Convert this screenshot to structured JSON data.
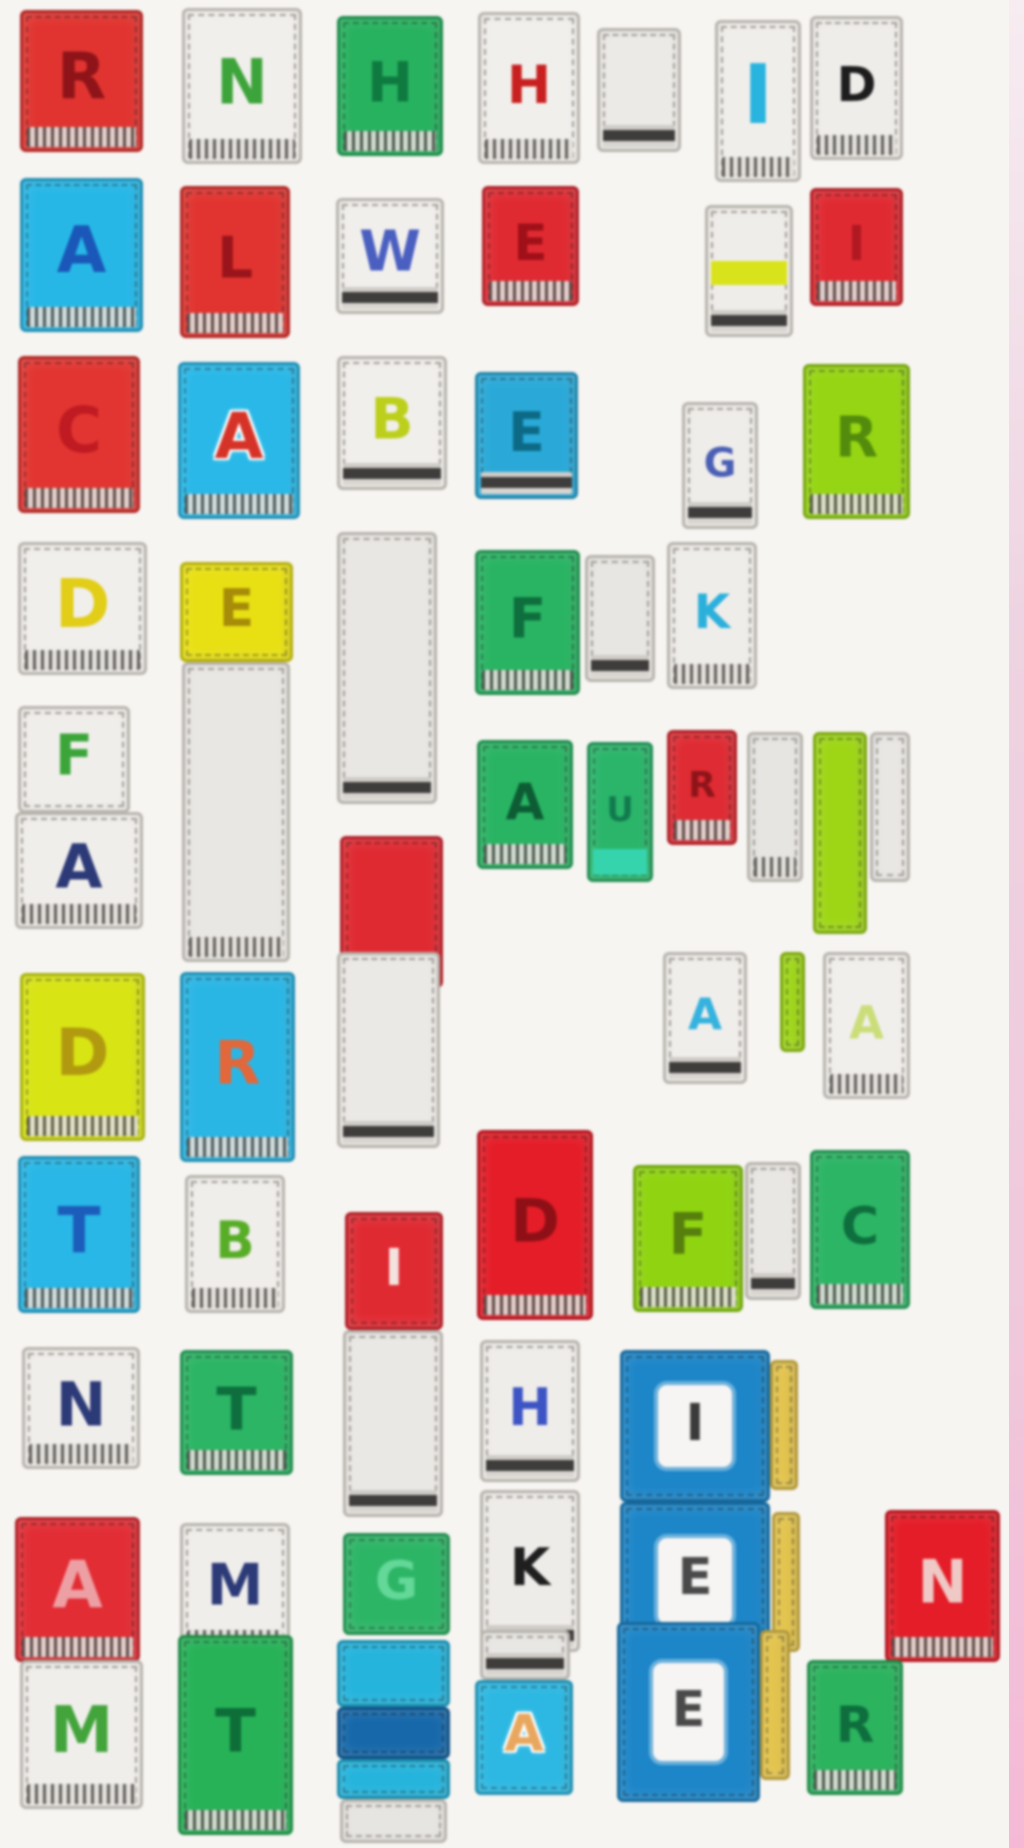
{
  "scene": {
    "description": "Blurry photo collage of toy alphabet letter blocks on a white background",
    "background": "#f7f5f2",
    "edge_strip_color": "#f0cfe0"
  },
  "blocks": [
    {
      "letter": "R",
      "letter_color": "#8e1419",
      "bg": "#e13430",
      "x": 20,
      "y": 10,
      "w": 123,
      "h": 142,
      "fringe": "s"
    },
    {
      "letter": "N",
      "letter_color": "#3ca43a",
      "bg": "#f1efec",
      "x": 182,
      "y": 8,
      "w": 120,
      "h": 156,
      "fringe": "s",
      "light": true
    },
    {
      "letter": "H",
      "letter_color": "#0f7a40",
      "bg": "#27b25f",
      "x": 337,
      "y": 16,
      "w": 106,
      "h": 140,
      "fringe": "s"
    },
    {
      "letter": "H",
      "letter_color": "#c8201f",
      "bg": "#f1efec",
      "x": 478,
      "y": 12,
      "w": 102,
      "h": 152,
      "fringe": "s",
      "light": true
    },
    {
      "letter": "",
      "letter_color": "",
      "bg": "#eceae7",
      "x": 597,
      "y": 28,
      "w": 84,
      "h": 124,
      "fringe": "d",
      "light": true
    },
    {
      "letter": "I",
      "letter_color": "#28b4de",
      "bg": "#f0eeeb",
      "x": 715,
      "y": 20,
      "w": 86,
      "h": 162,
      "fringe": "s",
      "light": true,
      "fs": 82
    },
    {
      "letter": "D",
      "letter_color": "#1d1d1d",
      "bg": "#efedea",
      "x": 810,
      "y": 16,
      "w": 93,
      "h": 144,
      "fringe": "s",
      "light": true
    },
    {
      "letter": "A",
      "letter_color": "#1a57b8",
      "bg": "#27b7e6",
      "x": 20,
      "y": 178,
      "w": 123,
      "h": 154,
      "fringe": "s"
    },
    {
      "letter": "L",
      "letter_color": "#9a141b",
      "bg": "#e13430",
      "x": 180,
      "y": 186,
      "w": 110,
      "h": 152,
      "fringe": "s"
    },
    {
      "letter": "W",
      "letter_color": "#4a5fc0",
      "bg": "#f1efec",
      "x": 336,
      "y": 198,
      "w": 108,
      "h": 116,
      "fringe": "d",
      "light": true
    },
    {
      "letter": "E",
      "letter_color": "#a01018",
      "bg": "#e02a32",
      "x": 482,
      "y": 186,
      "w": 97,
      "h": 120,
      "fringe": "s"
    },
    {
      "letter": "",
      "letter_color": "",
      "bg": "#efedea",
      "x": 705,
      "y": 205,
      "w": 88,
      "h": 132,
      "fringe": "d",
      "light": true,
      "hband": "#d9e31c"
    },
    {
      "letter": "I",
      "letter_color": "#b01822",
      "bg": "#e02a32",
      "x": 810,
      "y": 188,
      "w": 93,
      "h": 118,
      "fringe": "s"
    },
    {
      "letter": "C",
      "letter_color": "#c01b22",
      "bg": "#e23531",
      "x": 18,
      "y": 356,
      "w": 122,
      "h": 157,
      "fringe": "s"
    },
    {
      "letter": "A",
      "letter_color": "#d63328",
      "bg": "#29b8e7",
      "x": 178,
      "y": 362,
      "w": 122,
      "h": 157,
      "fringe": "s",
      "shadow": true
    },
    {
      "letter": "B",
      "letter_color": "#bccf1b",
      "bg": "#f1efec",
      "x": 337,
      "y": 356,
      "w": 110,
      "h": 134,
      "fringe": "d",
      "light": true
    },
    {
      "letter": "E",
      "letter_color": "#0d6a86",
      "bg": "#2aa9d8",
      "x": 475,
      "y": 372,
      "w": 103,
      "h": 127,
      "fringe": "d"
    },
    {
      "letter": "G",
      "letter_color": "#4a5fb5",
      "bg": "#efedea",
      "x": 682,
      "y": 402,
      "w": 76,
      "h": 127,
      "fringe": "d",
      "light": true
    },
    {
      "letter": "R",
      "letter_color": "#538c0c",
      "bg": "#96d513",
      "x": 803,
      "y": 364,
      "w": 107,
      "h": 155,
      "fringe": "s"
    },
    {
      "letter": "D",
      "letter_color": "#e2cd17",
      "bg": "#f1efec",
      "x": 18,
      "y": 542,
      "w": 129,
      "h": 133,
      "fringe": "s",
      "light": true
    },
    {
      "letter": "E",
      "letter_color": "#a68c08",
      "bg": "#e8e013",
      "x": 180,
      "y": 562,
      "w": 113,
      "h": 100,
      "fringe": "n"
    },
    {
      "letter": "",
      "letter_color": "",
      "bg": "#e9e7e4",
      "x": 182,
      "y": 662,
      "w": 108,
      "h": 300,
      "fringe": "s",
      "light": true
    },
    {
      "letter": "",
      "letter_color": "",
      "bg": "#e9e7e4",
      "x": 337,
      "y": 532,
      "w": 100,
      "h": 272,
      "fringe": "d",
      "light": true
    },
    {
      "letter": "F",
      "letter_color": "#0e6e3d",
      "bg": "#29b463",
      "x": 475,
      "y": 550,
      "w": 105,
      "h": 145,
      "fringe": "s"
    },
    {
      "letter": "",
      "letter_color": "",
      "bg": "#e8e6e3",
      "x": 585,
      "y": 555,
      "w": 70,
      "h": 127,
      "fringe": "d",
      "light": true
    },
    {
      "letter": "K",
      "letter_color": "#2bb0dc",
      "bg": "#efedea",
      "x": 667,
      "y": 542,
      "w": 90,
      "h": 147,
      "fringe": "s",
      "light": true
    },
    {
      "letter": "F",
      "letter_color": "#3ba53a",
      "bg": "#f0eeeb",
      "x": 18,
      "y": 706,
      "w": 112,
      "h": 107,
      "fringe": "n",
      "light": true
    },
    {
      "letter": "A",
      "letter_color": "#2c3a78",
      "bg": "#f0eeeb",
      "x": 15,
      "y": 812,
      "w": 128,
      "h": 117,
      "fringe": "s",
      "light": true
    },
    {
      "letter": "",
      "letter_color": "",
      "bg": "#e02a32",
      "x": 340,
      "y": 836,
      "w": 103,
      "h": 152,
      "fringe": "s"
    },
    {
      "letter": "A",
      "letter_color": "#0d5c34",
      "bg": "#29b463",
      "x": 477,
      "y": 740,
      "w": 96,
      "h": 129,
      "fringe": "s"
    },
    {
      "letter": "U",
      "letter_color": "#127a4e",
      "bg": "#2ab56a",
      "x": 587,
      "y": 742,
      "w": 66,
      "h": 140,
      "fringe": "n",
      "bband": "#35d4ad"
    },
    {
      "letter": "R",
      "letter_color": "#8e1419",
      "bg": "#df2b33",
      "x": 667,
      "y": 730,
      "w": 70,
      "h": 115,
      "fringe": "s"
    },
    {
      "letter": "",
      "letter_color": "",
      "bg": "#e7e5e2",
      "x": 747,
      "y": 732,
      "w": 56,
      "h": 150,
      "fringe": "s",
      "light": true
    },
    {
      "letter": "",
      "letter_color": "",
      "bg": "#9ed616",
      "x": 813,
      "y": 732,
      "w": 54,
      "h": 202,
      "fringe": "n"
    },
    {
      "letter": "",
      "letter_color": "",
      "bg": "#e9e7e4",
      "x": 870,
      "y": 732,
      "w": 40,
      "h": 150,
      "fringe": "n",
      "light": true
    },
    {
      "letter": "D",
      "letter_color": "#b29a10",
      "bg": "#d8e414",
      "x": 20,
      "y": 973,
      "w": 125,
      "h": 168,
      "fringe": "s"
    },
    {
      "letter": "R",
      "letter_color": "#e2673a",
      "bg": "#2ab6e5",
      "x": 180,
      "y": 972,
      "w": 115,
      "h": 190,
      "fringe": "s"
    },
    {
      "letter": "",
      "letter_color": "",
      "bg": "#ebe9e6",
      "x": 337,
      "y": 952,
      "w": 103,
      "h": 196,
      "fringe": "d",
      "light": true
    },
    {
      "letter": "A",
      "letter_color": "#35b2de",
      "bg": "#f0eeeb",
      "x": 663,
      "y": 952,
      "w": 84,
      "h": 132,
      "fringe": "d",
      "light": true
    },
    {
      "letter": "",
      "letter_color": "",
      "bg": "#9ed616",
      "x": 780,
      "y": 952,
      "w": 25,
      "h": 100,
      "fringe": "n"
    },
    {
      "letter": "A",
      "letter_color": "#cadd79",
      "bg": "#f1efec",
      "x": 823,
      "y": 952,
      "w": 87,
      "h": 147,
      "fringe": "s",
      "light": true
    },
    {
      "letter": "T",
      "letter_color": "#1c5cba",
      "bg": "#28b7e6",
      "x": 18,
      "y": 1156,
      "w": 122,
      "h": 157,
      "fringe": "s"
    },
    {
      "letter": "B",
      "letter_color": "#58ad27",
      "bg": "#f0eeeb",
      "x": 185,
      "y": 1175,
      "w": 100,
      "h": 138,
      "fringe": "s",
      "light": true
    },
    {
      "letter": "I",
      "letter_color": "#f3e3df",
      "bg": "#e02a32",
      "x": 345,
      "y": 1212,
      "w": 98,
      "h": 118,
      "fringe": "n"
    },
    {
      "letter": "D",
      "letter_color": "#8e1016",
      "bg": "#e41d28",
      "x": 477,
      "y": 1130,
      "w": 116,
      "h": 190,
      "fringe": "s"
    },
    {
      "letter": "F",
      "letter_color": "#567f0d",
      "bg": "#90d411",
      "x": 633,
      "y": 1165,
      "w": 110,
      "h": 147,
      "fringe": "s"
    },
    {
      "letter": "",
      "letter_color": "",
      "bg": "#e9e7e4",
      "x": 745,
      "y": 1162,
      "w": 56,
      "h": 138,
      "fringe": "d",
      "light": true
    },
    {
      "letter": "C",
      "letter_color": "#0e6e3d",
      "bg": "#2cb565",
      "x": 810,
      "y": 1150,
      "w": 100,
      "h": 159,
      "fringe": "s"
    },
    {
      "letter": "N",
      "letter_color": "#2c3a78",
      "bg": "#f0eeeb",
      "x": 22,
      "y": 1347,
      "w": 118,
      "h": 122,
      "fringe": "s",
      "light": true
    },
    {
      "letter": "T",
      "letter_color": "#0e6e3d",
      "bg": "#2bb564",
      "x": 180,
      "y": 1350,
      "w": 113,
      "h": 125,
      "fringe": "s"
    },
    {
      "letter": "",
      "letter_color": "",
      "bg": "#eae8e5",
      "x": 343,
      "y": 1330,
      "w": 100,
      "h": 187,
      "fringe": "d",
      "light": true
    },
    {
      "letter": "H",
      "letter_color": "#3d55c4",
      "bg": "#efedea",
      "x": 480,
      "y": 1340,
      "w": 100,
      "h": 142,
      "fringe": "d",
      "light": true
    },
    {
      "letter": "I",
      "letter_color": "#3a3a3a",
      "bg": "#1d86c8",
      "x": 620,
      "y": 1350,
      "w": 150,
      "h": 152,
      "fringe": "n",
      "variant": "face"
    },
    {
      "letter": "",
      "letter_color": "",
      "bg": "#e3c34b",
      "x": 770,
      "y": 1360,
      "w": 28,
      "h": 130,
      "fringe": "n"
    },
    {
      "letter": "A",
      "letter_color": "#eda0a4",
      "bg": "#e22d35",
      "x": 15,
      "y": 1517,
      "w": 125,
      "h": 145,
      "fringe": "s"
    },
    {
      "letter": "M",
      "letter_color": "#2c3a78",
      "bg": "#f0eeeb",
      "x": 180,
      "y": 1523,
      "w": 110,
      "h": 132,
      "fringe": "s",
      "light": true
    },
    {
      "letter": "G",
      "letter_color": "#63d898",
      "bg": "#2db566",
      "x": 343,
      "y": 1533,
      "w": 107,
      "h": 102,
      "fringe": "n"
    },
    {
      "letter": "K",
      "letter_color": "#1f1f1f",
      "bg": "#eeece9",
      "x": 480,
      "y": 1490,
      "w": 100,
      "h": 162,
      "fringe": "d",
      "light": true
    },
    {
      "letter": "E",
      "letter_color": "#4a4a4a",
      "bg": "#1d86c8",
      "x": 620,
      "y": 1502,
      "w": 150,
      "h": 158,
      "fringe": "n",
      "variant": "face"
    },
    {
      "letter": "",
      "letter_color": "",
      "bg": "#e3c34b",
      "x": 772,
      "y": 1512,
      "w": 28,
      "h": 140,
      "fringe": "n"
    },
    {
      "letter": "N",
      "letter_color": "#efc9c6",
      "bg": "#e41d28",
      "x": 885,
      "y": 1510,
      "w": 115,
      "h": 152,
      "fringe": "s"
    },
    {
      "letter": "M",
      "letter_color": "#42a43b",
      "bg": "#f0eeeb",
      "x": 20,
      "y": 1660,
      "w": 123,
      "h": 149,
      "fringe": "s",
      "light": true
    },
    {
      "letter": "T",
      "letter_color": "#0d6e38",
      "bg": "#27b258",
      "x": 178,
      "y": 1635,
      "w": 115,
      "h": 200,
      "fringe": "s"
    },
    {
      "letter": "",
      "letter_color": "",
      "bg": "#25b4dc",
      "x": 337,
      "y": 1640,
      "w": 113,
      "h": 67,
      "fringe": "n"
    },
    {
      "letter": "",
      "letter_color": "",
      "bg": "#1668aa",
      "x": 337,
      "y": 1707,
      "w": 113,
      "h": 52,
      "fringe": "n"
    },
    {
      "letter": "",
      "letter_color": "",
      "bg": "#25b4dc",
      "x": 337,
      "y": 1759,
      "w": 113,
      "h": 40,
      "fringe": "n"
    },
    {
      "letter": "",
      "letter_color": "",
      "bg": "#e7e5e2",
      "x": 340,
      "y": 1799,
      "w": 107,
      "h": 44,
      "fringe": "n",
      "light": true
    },
    {
      "letter": "",
      "letter_color": "",
      "bg": "#e9e7e4",
      "x": 480,
      "y": 1630,
      "w": 90,
      "h": 50,
      "fringe": "d",
      "light": true
    },
    {
      "letter": "A",
      "letter_color": "#e8a75e",
      "bg": "#2cb8e2",
      "x": 475,
      "y": 1680,
      "w": 98,
      "h": 115,
      "fringe": "n",
      "shadow": true
    },
    {
      "letter": "E",
      "letter_color": "#4a4a4a",
      "bg": "#1d86c8",
      "x": 617,
      "y": 1622,
      "w": 143,
      "h": 180,
      "fringe": "n",
      "variant": "face"
    },
    {
      "letter": "",
      "letter_color": "",
      "bg": "#e3c34b",
      "x": 760,
      "y": 1630,
      "w": 30,
      "h": 150,
      "fringe": "n"
    },
    {
      "letter": "R",
      "letter_color": "#0e6e3d",
      "bg": "#2bb35e",
      "x": 807,
      "y": 1660,
      "w": 96,
      "h": 135,
      "fringe": "s"
    }
  ]
}
